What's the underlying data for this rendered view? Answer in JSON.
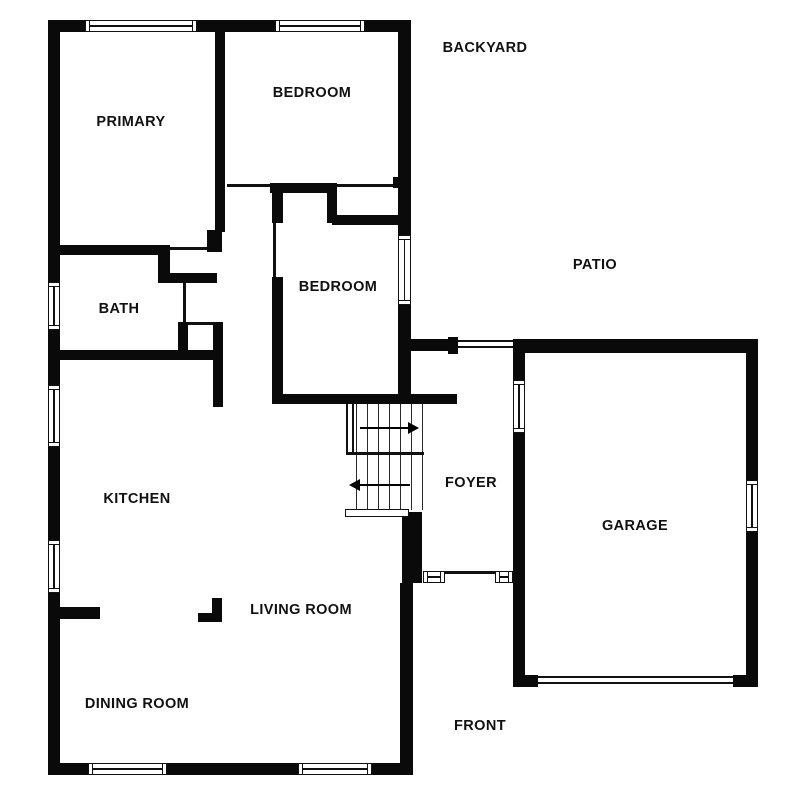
{
  "colors": {
    "wall": "#0a0a0a",
    "line": "#111111",
    "background": "#ffffff",
    "text": "#111111"
  },
  "plan": {
    "outdoor_labels": [
      {
        "id": "backyard",
        "label": "BACKYARD"
      },
      {
        "id": "patio",
        "label": "PATIO"
      },
      {
        "id": "front",
        "label": "FRONT"
      }
    ],
    "room_labels": [
      {
        "id": "primary",
        "label": "PRIMARY"
      },
      {
        "id": "bedroom-top",
        "label": "BEDROOM"
      },
      {
        "id": "bedroom-middle",
        "label": "BEDROOM"
      },
      {
        "id": "bath",
        "label": "BATH"
      },
      {
        "id": "kitchen",
        "label": "KITCHEN"
      },
      {
        "id": "foyer",
        "label": "FOYER"
      },
      {
        "id": "garage",
        "label": "GARAGE"
      },
      {
        "id": "living-room",
        "label": "LIVING ROOM"
      },
      {
        "id": "dining-room",
        "label": "DINING ROOM"
      }
    ]
  }
}
